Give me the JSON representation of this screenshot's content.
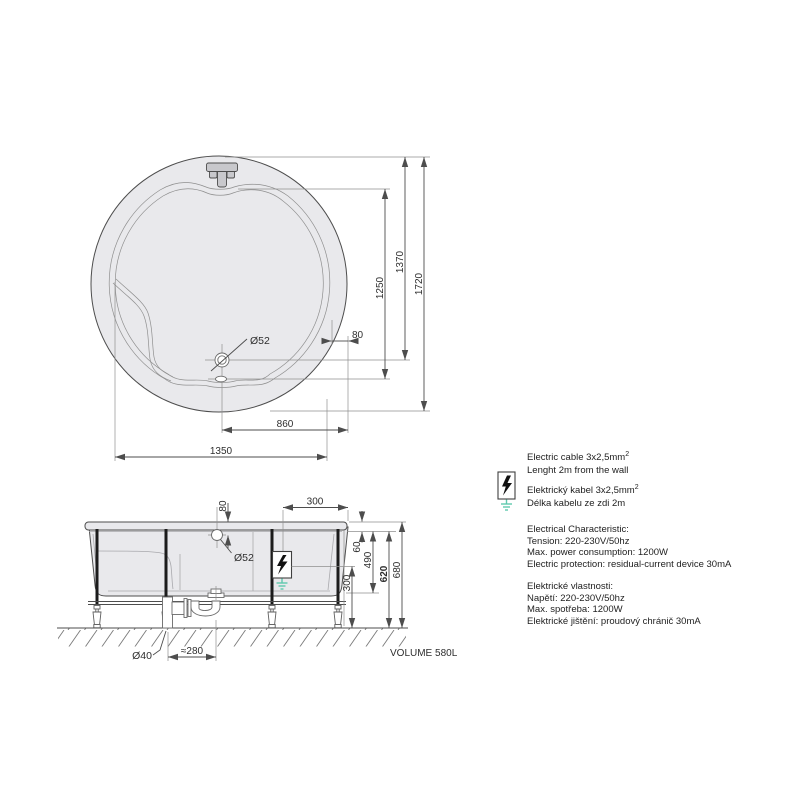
{
  "colors": {
    "line": "#4d4d4d",
    "fill": "#e9e9ec",
    "ground_green": "#5fc9ae"
  },
  "top_view": {
    "dim_overall": "1720",
    "dim_1370": "1370",
    "dim_1250": "1250",
    "dim_rim": "80",
    "dim_860": "860",
    "dim_1350": "1350",
    "label_drain": "Ø52"
  },
  "side_view": {
    "dim_overflow_depth": "80",
    "dim_300_top": "300",
    "dim_60": "60",
    "dim_490": "490",
    "dim_620": "620",
    "dim_680": "680",
    "dim_300_right": "300",
    "dim_trap_offset": "≈280",
    "label_pipe": "Ø40",
    "label_overflow": "Ø52"
  },
  "volume_label": "VOLUME 580L",
  "legend": {
    "en": {
      "line1": "Electric cable 3x2,5mm",
      "sup": "2",
      "line2": "Lenght 2m from the wall"
    },
    "cz": {
      "line1": "Elektrický kabel 3x2,5mm",
      "sup": "2",
      "line2": "Délka kabelu ze zdi 2m"
    },
    "char_en": {
      "title": "Electrical Characteristic:",
      "lines": [
        "Tension: 220-230V/50hz",
        "Max. power consumption: 1200W",
        "Electric protection: residual-current device 30mA"
      ]
    },
    "char_cz": {
      "title": "Elektrické vlastnosti:",
      "lines": [
        "Napětí: 220-230V/50hz",
        "Max. spotřeba: 1200W",
        "Elektrické jištění: proudový chránič 30mA"
      ]
    }
  }
}
